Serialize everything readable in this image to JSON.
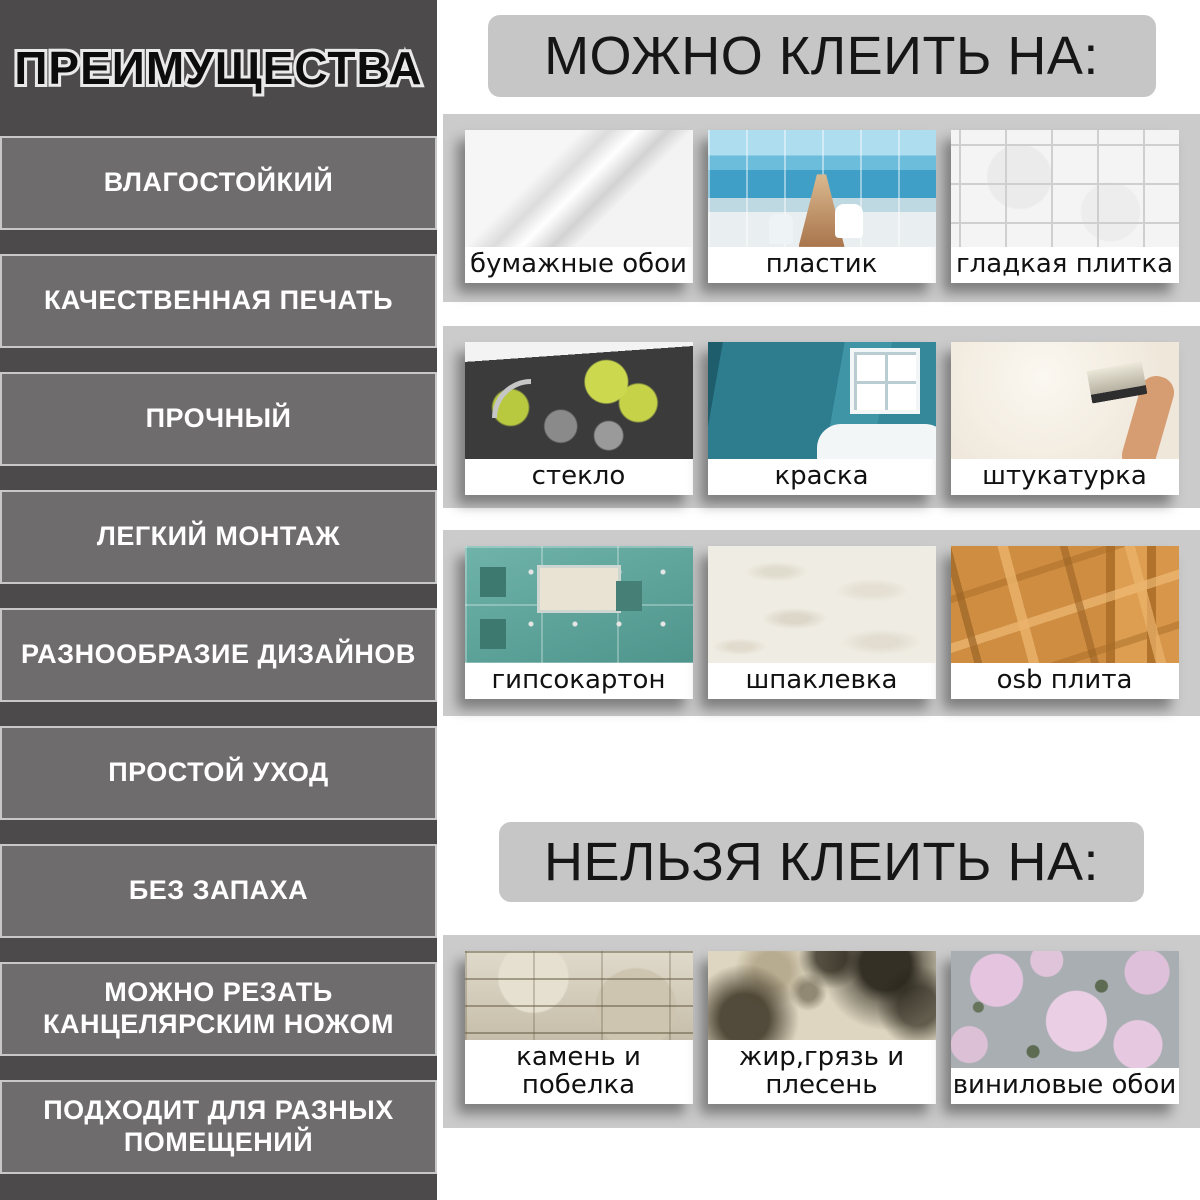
{
  "colors": {
    "sidebar_bg": "#4c4a4b",
    "sidebar_item_bg": "#6e6c6d",
    "sidebar_item_border": "#c8c8c8",
    "sidebar_item_text": "#ffffff",
    "title_text": "#0c0c0c",
    "title_outline": "#e9e9e9",
    "right_bg": "#ffffff",
    "header_pill_bg": "#c6c6c6",
    "header_pill_text": "#161616",
    "band_bg": "#cbcbcb",
    "card_label_bg": "#ffffff",
    "card_label_text": "#111111"
  },
  "sidebar": {
    "title": "ПРЕИМУЩЕСТВА",
    "items": [
      "ВЛАГОСТОЙКИЙ",
      "КАЧЕСТВЕННАЯ ПЕЧАТЬ",
      "ПРОЧНЫЙ",
      "ЛЕГКИЙ МОНТАЖ",
      "РАЗНООБРАЗИЕ ДИЗАЙНОВ",
      "ПРОСТОЙ УХОД",
      "БЕЗ ЗАПАХА",
      "МОЖНО РЕЗАТЬ КАНЦЕЛЯРСКИМ НОЖОМ",
      "ПОДХОДИТ ДЛЯ РАЗНЫХ ПОМЕЩЕНИЙ"
    ]
  },
  "can_section": {
    "header": "МОЖНО КЛЕИТЬ НА:",
    "rows": [
      {
        "items": [
          {
            "label": "бумажные обои",
            "image": "paper-wallpaper-roll-photo"
          },
          {
            "label": "пластик",
            "image": "plastic-panel-bathroom-photo"
          },
          {
            "label": "гладкая плитка",
            "image": "smooth-white-tile-photo"
          }
        ]
      },
      {
        "items": [
          {
            "label": "стекло",
            "image": "glass-kitchen-splashback-photo"
          },
          {
            "label": "краска",
            "image": "teal-painted-wall-photo"
          },
          {
            "label": "штукатурка",
            "image": "plastering-wall-photo"
          }
        ]
      },
      {
        "items": [
          {
            "label": "гипсокартон",
            "image": "green-drywall-photo"
          },
          {
            "label": "шпаклевка",
            "image": "putty-texture-photo"
          },
          {
            "label": "osb плита",
            "image": "osb-board-photo"
          }
        ]
      }
    ]
  },
  "cannot_section": {
    "header": "НЕЛЬЗЯ КЛЕИТЬ НА:",
    "rows": [
      {
        "items": [
          {
            "label": "камень и побелка",
            "image": "stone-and-whitewash-photo"
          },
          {
            "label": "жир,грязь и плесень",
            "image": "grease-dirt-mold-photo"
          },
          {
            "label": "виниловые обои",
            "image": "vinyl-wallpaper-photo"
          }
        ]
      }
    ]
  }
}
